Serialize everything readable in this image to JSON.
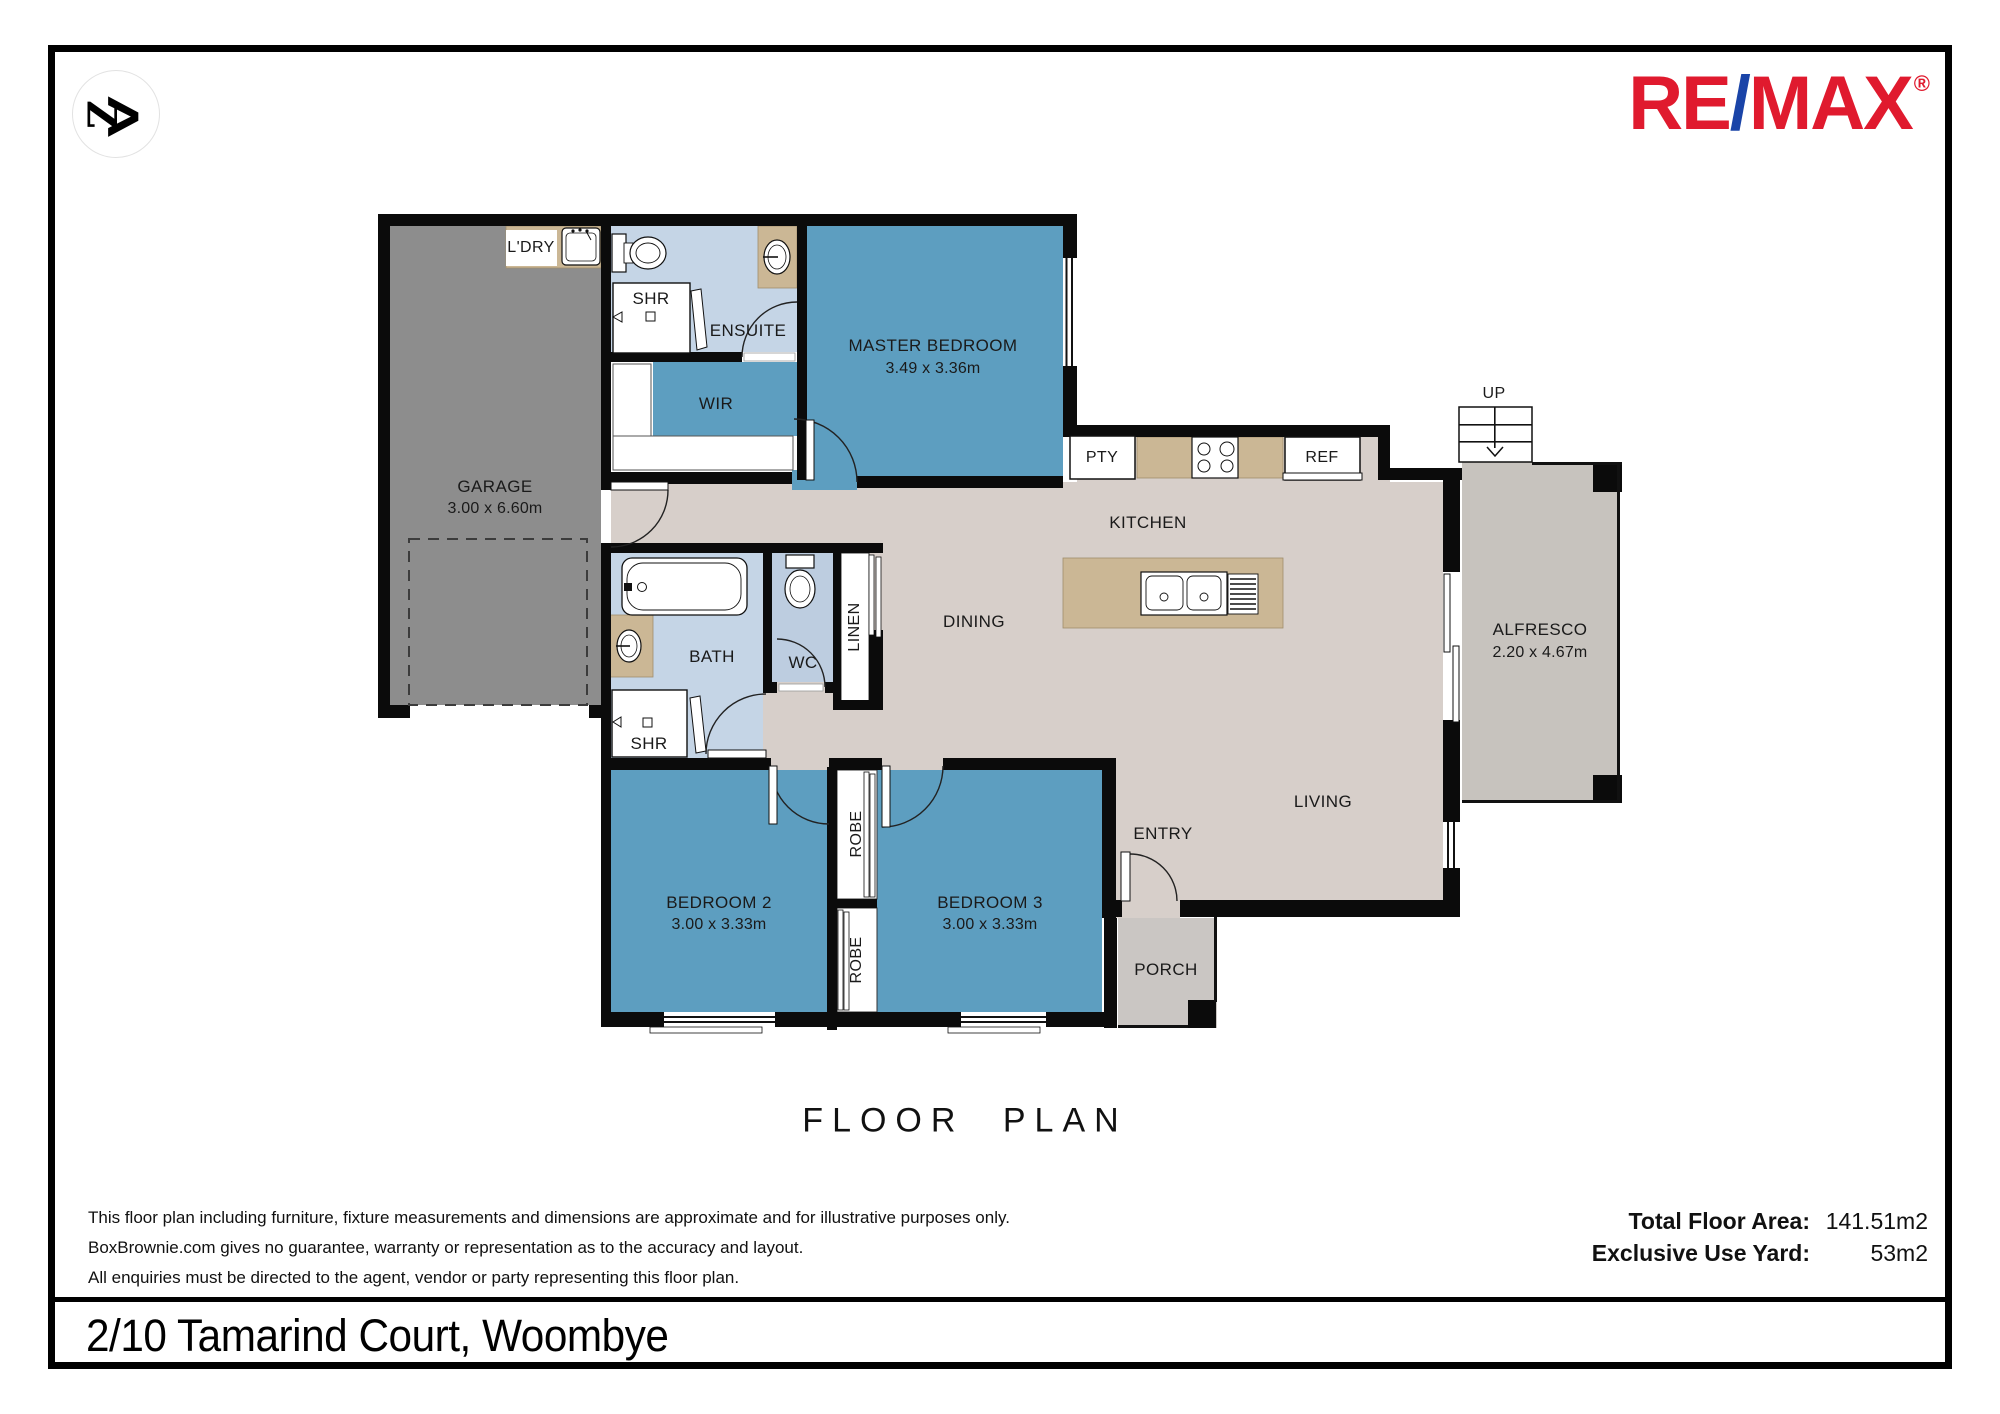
{
  "logo": {
    "monogram_letter": "Z",
    "chevron": ">"
  },
  "brand": {
    "re": "RE",
    "slash": "/",
    "max": "MAX",
    "registered": "®",
    "red": "#e01a2e",
    "blue": "#1a44a8"
  },
  "colors": {
    "wall": "#0b0b0b",
    "floor": "#d7cfca",
    "bedroom_blue": "#5d9ec0",
    "bathroom_blue": "#c5d5e6",
    "wc_blue": "#bdcde0",
    "alfresco_grey": "#c7c3be",
    "porch_grey": "#cac6c3",
    "garage_grey": "#8d8d8d",
    "counter_tan": "#cbb795"
  },
  "plan": {
    "labels": {
      "garage": {
        "name": "GARAGE",
        "dims": "3.00 x 6.60m"
      },
      "master_bedroom": {
        "name": "MASTER BEDROOM",
        "dims": "3.49 x 3.36m"
      },
      "bedroom2": {
        "name": "BEDROOM 2",
        "dims": "3.00 x 3.33m"
      },
      "bedroom3": {
        "name": "BEDROOM 3",
        "dims": "3.00 x 3.33m"
      },
      "alfresco": {
        "name": "ALFRESCO",
        "dims": "2.20 x 4.67m"
      },
      "laundry": "L'DRY",
      "ensuite": "ENSUITE",
      "shower_ensuite": "SHR",
      "wir": "WIR",
      "pantry": "PTY",
      "fridge": "REF",
      "stairs_up": "UP",
      "kitchen": "KITCHEN",
      "dining": "DINING",
      "bath": "BATH",
      "wc": "WC",
      "shower_bath": "SHR",
      "linen": "LINEN",
      "living": "LIVING",
      "entry": "ENTRY",
      "porch": "PORCH",
      "robe_upper": "ROBE",
      "robe_lower": "ROBE"
    }
  },
  "footer": {
    "title": "FLOOR PLAN",
    "disclaimer": [
      "This floor plan including furniture, fixture measurements and dimensions are approximate and for illustrative purposes only.",
      "BoxBrownie.com gives no guarantee, warranty or representation as to the accuracy and layout.",
      "All enquiries must be directed to the agent, vendor or party representing this floor plan."
    ],
    "total_floor_area_label": "Total Floor Area:",
    "total_floor_area_value": "141.51m2",
    "exclusive_yard_label": "Exclusive Use Yard:",
    "exclusive_yard_value": "53m2",
    "address": "2/10 Tamarind Court, Woombye"
  }
}
